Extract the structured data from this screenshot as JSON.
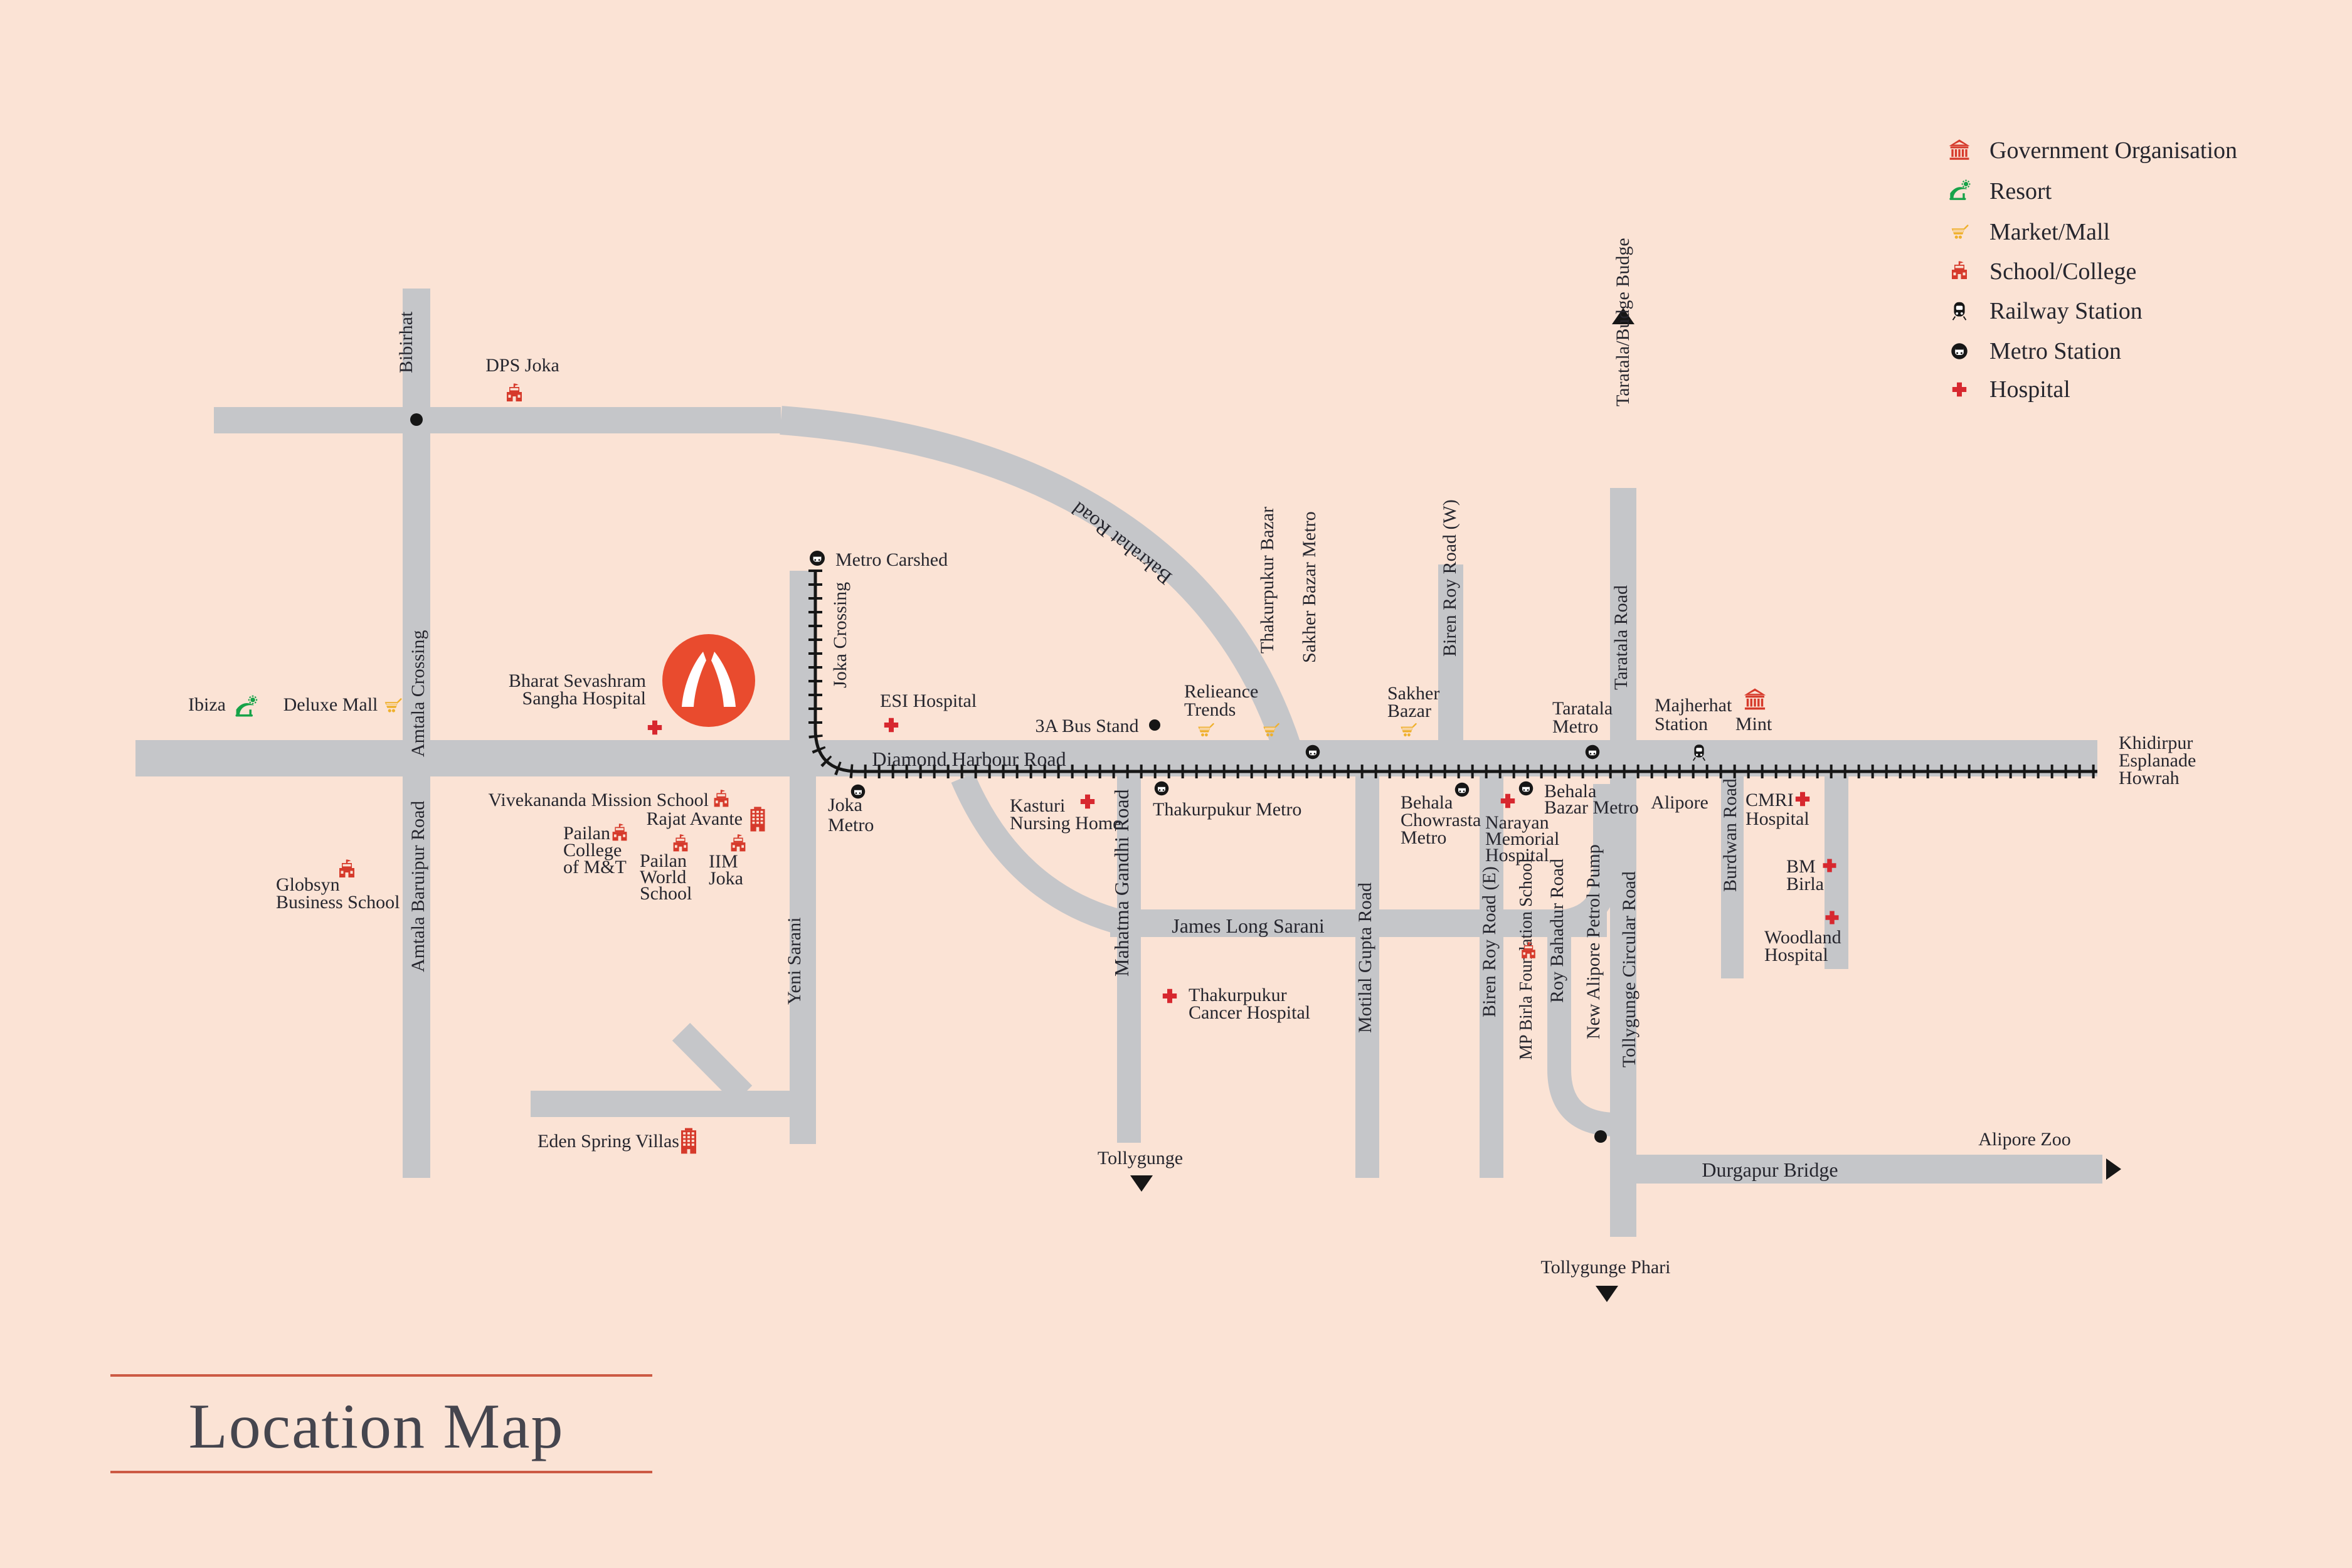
{
  "title": {
    "text": "Location Map"
  },
  "legend": {
    "items": [
      {
        "label": "Government Organisation",
        "icon": "government-icon"
      },
      {
        "label": "Resort",
        "icon": "resort-icon"
      },
      {
        "label": "Market/Mall",
        "icon": "market-icon"
      },
      {
        "label": "School/College",
        "icon": "school-icon"
      },
      {
        "label": "Railway Station",
        "icon": "railway-station-icon"
      },
      {
        "label": "Metro Station",
        "icon": "metro-station-icon"
      },
      {
        "label": "Hospital",
        "icon": "hospital-icon"
      }
    ]
  },
  "map": {
    "colors": {
      "background": "#fbe3d5",
      "road": "#c5c6c9",
      "railway": "#161616",
      "label_text": "#26262e",
      "icon_red": "#d63a2b",
      "hospital_red": "#d7282f",
      "market_yellow": "#efb02c",
      "resort_green": "#17a349",
      "logo_red": "#e94b2e",
      "title_text": "#45454e",
      "title_line": "#cc5a44"
    },
    "labels": {
      "bibirhat": {
        "lines": [
          "Bibirhat"
        ]
      },
      "dps_joka": {
        "lines": [
          "DPS Joka"
        ],
        "icon": "school-icon"
      },
      "amtala_crossing": {
        "lines": [
          "Amtala Crossing"
        ]
      },
      "amtala_baruipur": {
        "lines": [
          "Amtala Baruipur Road"
        ]
      },
      "globsyn": {
        "lines": [
          "Globsyn",
          "Business School"
        ],
        "icon": "school-icon"
      },
      "ibiza": {
        "lines": [
          "Ibiza"
        ],
        "icon": "resort-icon"
      },
      "deluxe_mall": {
        "lines": [
          "Deluxe Mall"
        ],
        "icon": "market-icon"
      },
      "bharat": {
        "lines": [
          "Bharat Sevashram",
          "Sangha Hospital"
        ],
        "icon": "hospital-icon"
      },
      "metro_carshed": {
        "lines": [
          "Metro Carshed"
        ],
        "icon": "metro-station-icon"
      },
      "joka_crossing": {
        "lines": [
          "Joka Crossing"
        ]
      },
      "esi": {
        "lines": [
          "ESI Hospital"
        ],
        "icon": "hospital-icon"
      },
      "bus_stand": {
        "lines": [
          "3A Bus Stand"
        ]
      },
      "dhr": {
        "lines": [
          "Diamond Harbour Road"
        ]
      },
      "bakrahat": {
        "lines": [
          "Bakrahat Road"
        ]
      },
      "thakurpukur_bazar": {
        "lines": [
          "Thakurpukur Bazar"
        ],
        "icon": "market-icon"
      },
      "sakher_bazar_metro": {
        "lines": [
          "Sakher Bazar Metro"
        ],
        "icon": "metro-station-icon"
      },
      "relieance": {
        "lines": [
          "Relieance",
          "Trends"
        ],
        "icon": "market-icon"
      },
      "sakher_bazar": {
        "lines": [
          "Sakher",
          "Bazar"
        ],
        "icon": "market-icon"
      },
      "biren_w": {
        "lines": [
          "Biren Roy Road (W)"
        ]
      },
      "taratala_budge": {
        "lines": [
          "Taratala/Budge Budge"
        ]
      },
      "taratala_road": {
        "lines": [
          "Taratala Road"
        ]
      },
      "taratala_metro": {
        "lines": [
          "Taratala",
          "Metro"
        ],
        "icon": "metro-station-icon"
      },
      "majherhat": {
        "lines": [
          "Majherhat",
          "Station"
        ],
        "icon": "railway-station-icon"
      },
      "mint": {
        "lines": [
          "Mint"
        ],
        "icon": "government-icon"
      },
      "khidirpur": {
        "lines": [
          "Khidirpur",
          "Esplanade",
          "Howrah"
        ]
      },
      "joka_metro": {
        "lines": [
          "Joka",
          "Metro"
        ],
        "icon": "metro-station-icon"
      },
      "vivekananda": {
        "lines": [
          "Vivekananda Mission School"
        ],
        "icon": "school-icon"
      },
      "rajat": {
        "lines": [
          "Rajat Avante"
        ],
        "icon": "building-icon"
      },
      "pailan_college": {
        "lines": [
          "Pailan",
          "College",
          "of M&T"
        ],
        "icon": "school-icon"
      },
      "pailan_world": {
        "lines": [
          "Pailan",
          "World",
          "School"
        ],
        "icon": "school-icon"
      },
      "iim": {
        "lines": [
          "IIM",
          "Joka"
        ],
        "icon": "school-icon"
      },
      "yeni": {
        "lines": [
          "Yeni Sarani"
        ]
      },
      "thakurpukur_metro": {
        "lines": [
          "Thakurpukur Metro"
        ],
        "icon": "metro-station-icon"
      },
      "kasturi": {
        "lines": [
          "Kasturi",
          "Nursing Home"
        ],
        "icon": "hospital-icon"
      },
      "behala_chowrasta": {
        "lines": [
          "Behala",
          "Chowrasta",
          "Metro"
        ],
        "icon": "metro-station-icon"
      },
      "narayan": {
        "lines": [
          "Narayan",
          "Memorial",
          "Hospital"
        ],
        "icon": "hospital-icon"
      },
      "behala_bazar": {
        "lines": [
          "Behala",
          "Bazar Metro"
        ],
        "icon": "metro-station-icon"
      },
      "alipore": {
        "lines": [
          "Alipore"
        ]
      },
      "cmri": {
        "lines": [
          "CMRI",
          "Hospital"
        ],
        "icon": "hospital-icon"
      },
      "burdwan": {
        "lines": [
          "Burdwan Road"
        ]
      },
      "bm_birla": {
        "lines": [
          "BM",
          "Birla"
        ],
        "icon": "hospital-icon"
      },
      "woodland": {
        "lines": [
          "Woodland",
          "Hospital"
        ],
        "icon": "hospital-icon"
      },
      "james_long": {
        "lines": [
          "James Long Sarani"
        ]
      },
      "mahatma": {
        "lines": [
          "Mahatma Gandhi Road"
        ]
      },
      "tollygunge_s": {
        "lines": [
          "Tollygunge"
        ]
      },
      "thakurpukur_cancer": {
        "lines": [
          "Thakurpukur",
          "Cancer Hospital"
        ],
        "icon": "hospital-icon"
      },
      "motilal": {
        "lines": [
          "Motilal Gupta Road"
        ]
      },
      "biren_e": {
        "lines": [
          "Biren Roy Road (E)"
        ]
      },
      "mp_birla": {
        "lines": [
          "MP Birla Foundation School"
        ],
        "icon": "school-icon"
      },
      "roy_bahadur": {
        "lines": [
          "Roy Bahadur Road"
        ]
      },
      "new_alipore": {
        "lines": [
          "New Alipore Petrol Pump"
        ]
      },
      "tollygunge_circular": {
        "lines": [
          "Tollygunge Circular Road"
        ]
      },
      "eden": {
        "lines": [
          "Eden Spring Villas"
        ],
        "icon": "building-icon"
      },
      "durgapur": {
        "lines": [
          "Durgapur Bridge"
        ]
      },
      "alipore_zoo": {
        "lines": [
          "Alipore Zoo"
        ]
      },
      "tollygunge_phari": {
        "lines": [
          "Tollygunge Phari"
        ]
      }
    }
  }
}
